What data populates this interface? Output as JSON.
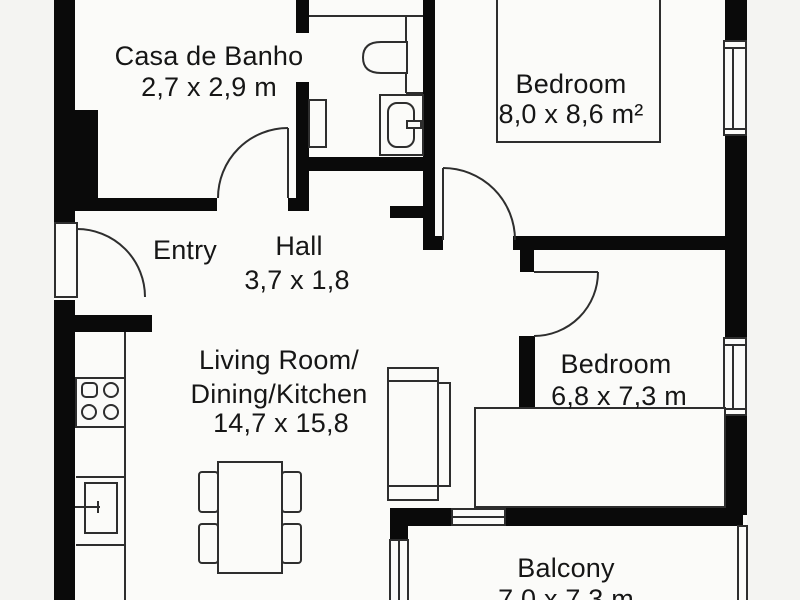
{
  "plan": {
    "type": "apartment-floor-plan",
    "colors": {
      "page_background": "#f4f4f2",
      "floor_background": "#fbfbf9",
      "wall": "#0a0a0a",
      "line": "#2e2e2e",
      "text": "#161616"
    },
    "rooms": [
      {
        "id": "bathroom",
        "name": "Casa de Banho",
        "dimensions": "2,7 x 2,9 m"
      },
      {
        "id": "bedroom-1",
        "name": "Bedroom",
        "dimensions": "8,0 x 8,6 m²"
      },
      {
        "id": "entry",
        "name": "Entry",
        "dimensions": ""
      },
      {
        "id": "hall",
        "name": "Hall",
        "dimensions": "3,7 x 1,8"
      },
      {
        "id": "living",
        "name": "Living Room/Dining/Kitchen",
        "dimensions": "14,7 x 15,8"
      },
      {
        "id": "bedroom-2",
        "name": "Bedroom",
        "dimensions": "6,8 x 7,3 m"
      },
      {
        "id": "balcony",
        "name": "Balcony",
        "dimensions": "7,0 x 7,3 m"
      }
    ],
    "fixtures": [
      "entry-door",
      "bathroom-door",
      "bedroom-1-door",
      "bedroom-2-door",
      "toilet",
      "wc-sink-vanity",
      "wc-radiator",
      "kitchen-counter",
      "stove-4-burners",
      "kitchen-sink",
      "dining-table",
      "chair",
      "chair",
      "chair",
      "chair",
      "sofa",
      "bed",
      "bed",
      "window-bedroom-1",
      "window-bedroom-2",
      "window-balcony-wall",
      "window-balcony-left",
      "window-balcony-right"
    ]
  },
  "labels": {
    "bathroom_name": "Casa de Banho",
    "bathroom_dim": "2,7 x 2,9 m",
    "bedroom1_name": "Bedroom",
    "bedroom1_dim": "8,0 x 8,6 m²",
    "entry_name": "Entry",
    "hall_name": "Hall",
    "hall_dim": "3,7 x 1,8",
    "living_line1": "Living Room/",
    "living_line2": "Dining/Kitchen",
    "living_dim": "14,7 x 15,8",
    "bedroom2_name": "Bedroom",
    "bedroom2_dim": "6,8 x 7,3 m",
    "balcony_name": "Balcony",
    "balcony_dim": "7,0 x 7,3 m"
  }
}
